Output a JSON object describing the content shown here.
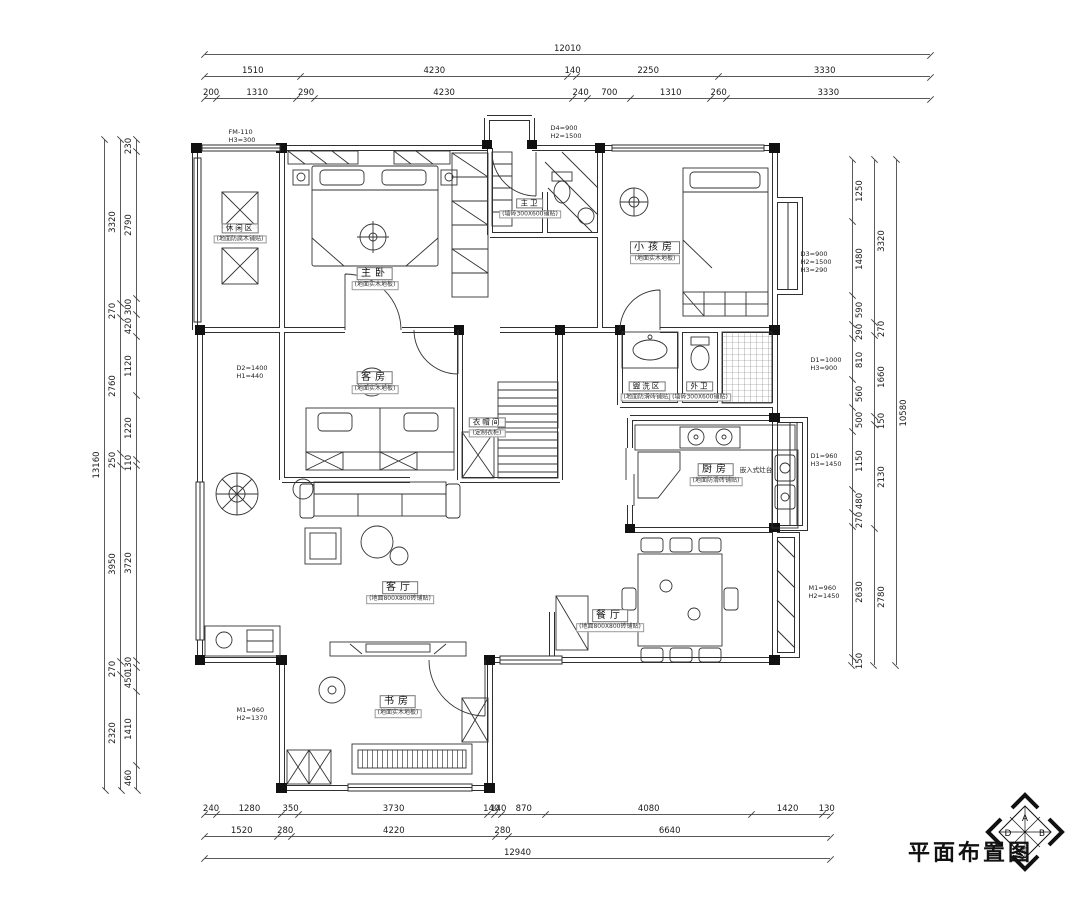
{
  "sheet": {
    "title": "平面布置图"
  },
  "compass": {
    "top": "A",
    "right": "B",
    "bottom": "C",
    "left": "D"
  },
  "rooms": {
    "leisure": {
      "label": "休闲区",
      "note": "(地面防腐木铺贴)"
    },
    "master": {
      "label": "主卧",
      "note": "(地面实木地板)"
    },
    "master_bath": {
      "label": "主卫",
      "note": "(墙砖300X600铺贴)"
    },
    "kids": {
      "label": "小孩房",
      "note": "(地面实木地板)"
    },
    "guest": {
      "label": "客房",
      "note": "(地面实木地板)"
    },
    "cloak": {
      "label": "衣帽间",
      "note": "(定制衣柜)"
    },
    "wash": {
      "label": "盥洗区",
      "note": "(地面防滑砖铺贴)"
    },
    "out_bath": {
      "label": "外卫",
      "note": "(墙砖300X600铺贴)"
    },
    "kitchen": {
      "label": "厨房",
      "note": "(地面防滑砖铺贴)"
    },
    "living": {
      "label": "客厅",
      "note": "(地面800X800砖铺贴)"
    },
    "dining": {
      "label": "餐厅",
      "note": "(地面800X800砖铺贴)"
    },
    "study": {
      "label": "书房",
      "note": "(地面实木地板)"
    }
  },
  "specs": {
    "top_left": "FM-110\nH3=300",
    "entry": "D4=900\nH2=1500",
    "kids_bay": "D3=900\nH2=1500\nH3=290",
    "wash_window": "D1=1000\nH3=900",
    "kitchen_window": "D1=960\nH3=1450",
    "dining_door": "M1=960\nH2=1450",
    "guest_window": "D2=1400\nH1=440",
    "study_door": "M1=960\nH2=1370",
    "stove": "嵌入式灶台"
  },
  "dims": {
    "top_total": [
      "12010"
    ],
    "top_mid": [
      "1510",
      "4230",
      "140",
      "2250",
      "3330"
    ],
    "top_inner": [
      "200",
      "1310",
      "290",
      "4230",
      "240",
      "700",
      "1310",
      "260",
      "3330"
    ],
    "bottom_inner": [
      "240",
      "1280",
      "350",
      "3730",
      "140",
      "140",
      "870",
      "4080",
      "1420",
      "130"
    ],
    "bottom_mid": [
      "1520",
      "280",
      "4220",
      "280",
      "6640"
    ],
    "bottom_total": [
      "12940"
    ],
    "left_total": [
      "13160"
    ],
    "left_mid": [
      "3320",
      "270",
      "2760",
      "250",
      "3950",
      "270",
      "2320"
    ],
    "left_inner": [
      "230",
      "2790",
      "300",
      "420",
      "1120",
      "1220",
      "110",
      "3720",
      "130",
      "450",
      "1410",
      "460"
    ],
    "right_inner": [
      "1250",
      "1480",
      "590",
      "290",
      "810",
      "560",
      "500",
      "1150",
      "480",
      "270",
      "2630",
      "150"
    ],
    "right_mid": [
      "3320",
      "270",
      "1660",
      "150",
      "2130",
      "2780"
    ],
    "right_total": [
      "10580"
    ]
  }
}
